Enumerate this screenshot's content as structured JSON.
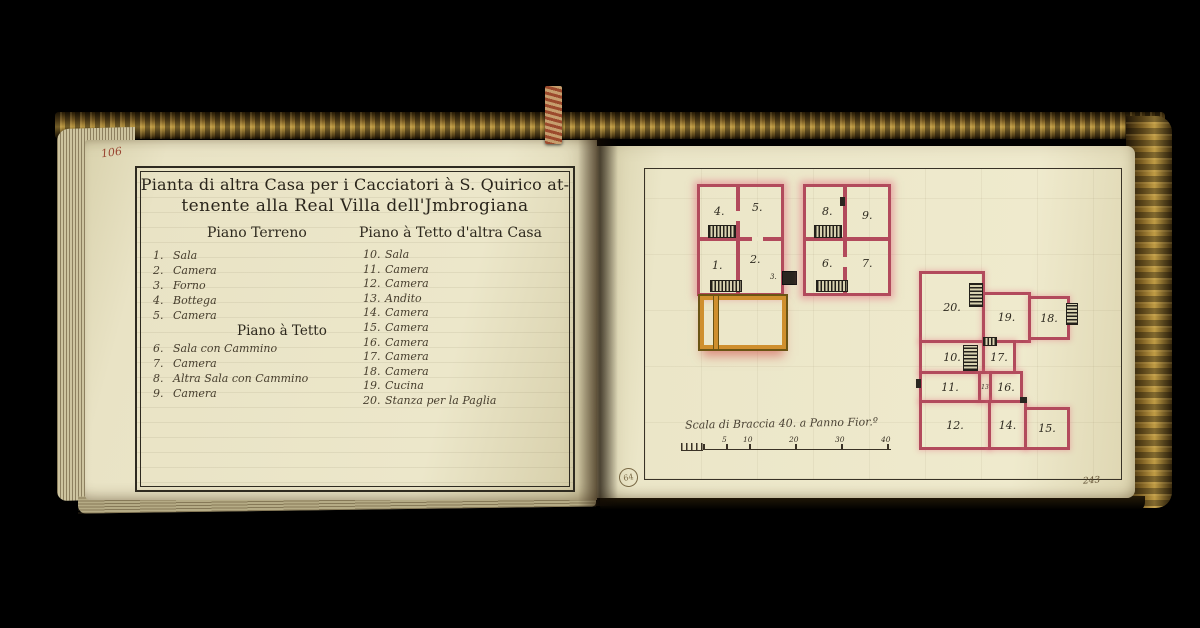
{
  "book": {
    "left_folio": "106",
    "right_folio": "243",
    "stamp": "64"
  },
  "left_page": {
    "title_line1": "Pianta di altra Casa per i Cacciatori à S. Quirico at-",
    "title_line2": "tenente alla Real Villa dell'Jmbrogiana",
    "col1_header": "Piano Terreno",
    "col2_header": "Piano à Tetto d'altra Casa",
    "sub_header": "Piano à Tetto",
    "ground_items": [
      {
        "n": "1.",
        "label": "Sala"
      },
      {
        "n": "2.",
        "label": "Camera"
      },
      {
        "n": "3.",
        "label": "Forno"
      },
      {
        "n": "4.",
        "label": "Bottega"
      },
      {
        "n": "5.",
        "label": "Camera"
      }
    ],
    "attic_items": [
      {
        "n": "6.",
        "label": "Sala con Cammino"
      },
      {
        "n": "7.",
        "label": "Camera"
      },
      {
        "n": "8.",
        "label": "Altra Sala con Cammino"
      },
      {
        "n": "9.",
        "label": "Camera"
      }
    ],
    "tetto_items": [
      {
        "n": "10.",
        "label": "Sala"
      },
      {
        "n": "11.",
        "label": "Camera"
      },
      {
        "n": "12.",
        "label": "Camera"
      },
      {
        "n": "13.",
        "label": "Andito"
      },
      {
        "n": "14.",
        "label": "Camera"
      },
      {
        "n": "15.",
        "label": "Camera"
      },
      {
        "n": "16.",
        "label": "Camera"
      },
      {
        "n": "17.",
        "label": "Camera"
      },
      {
        "n": "18.",
        "label": "Camera"
      },
      {
        "n": "19.",
        "label": "Cucina"
      },
      {
        "n": "20.",
        "label": "Stanza per la Paglia"
      }
    ]
  },
  "right_page": {
    "plan_terreno_rooms": [
      "4.",
      "5.",
      "1.",
      "2.",
      "3."
    ],
    "plan_tetto_small_rooms": [
      "8.",
      "9.",
      "6.",
      "7."
    ],
    "plan_tetto_large_rooms": [
      "20.",
      "19.",
      "18.",
      "10.",
      "17.",
      "11.",
      "13",
      "16.",
      "12.",
      "14.",
      "15."
    ],
    "scale_caption": "Scala di Braccia 40. a Panno Fior.º",
    "scale_ticks": [
      "5",
      "10",
      "20",
      "30",
      "40"
    ]
  },
  "colors": {
    "wall_red": "#b24a5c",
    "glow_pink": "#e2688a",
    "courtyard_orange": "#cf8f2e",
    "ink": "#3a3226",
    "page_cream": "#ece7c9",
    "gilt_gold": "#bd9a43"
  }
}
